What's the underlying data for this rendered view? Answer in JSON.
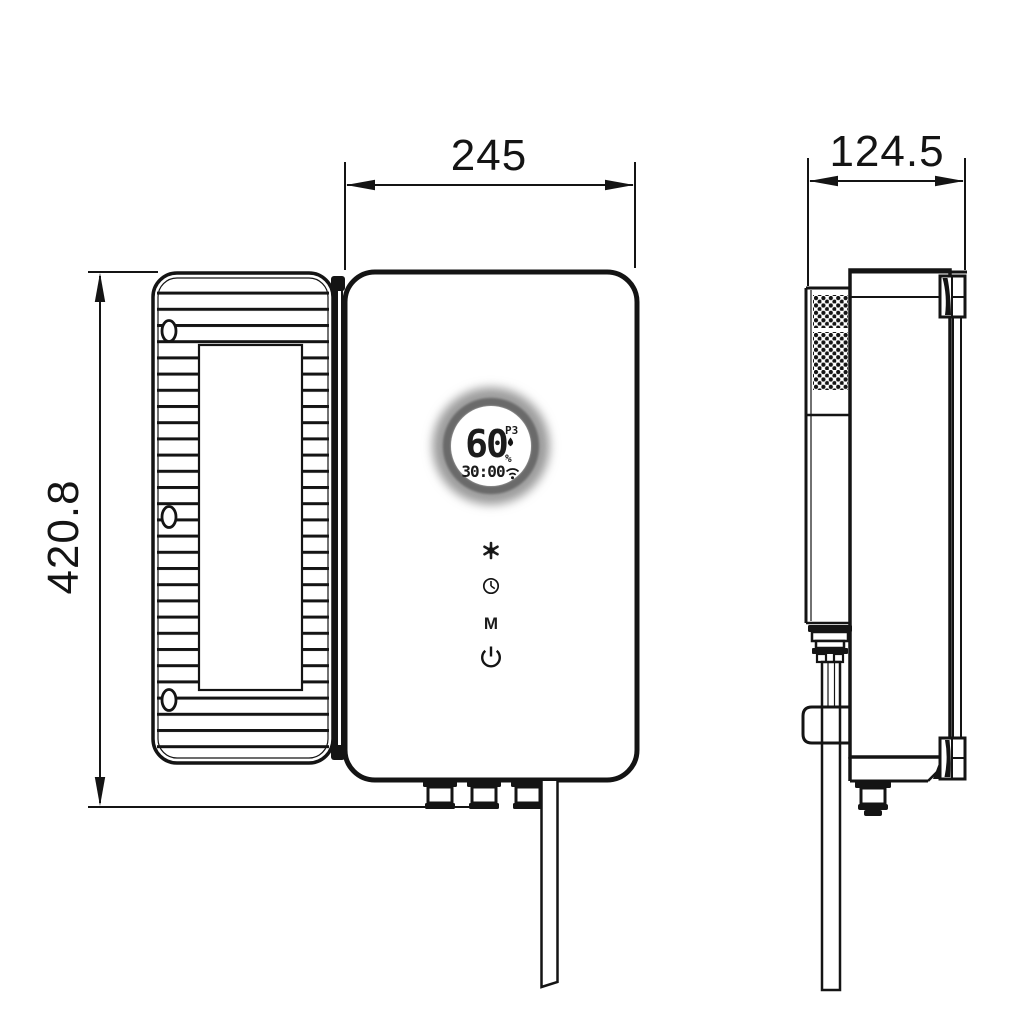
{
  "drawing": {
    "type": "technical-dimension-drawing",
    "subject": "wall-mounted-water-heater",
    "background": "#ffffff",
    "line_color": "#141414"
  },
  "dimensions": {
    "front_width": "245",
    "front_height": "420.8",
    "side_depth": "124.5"
  },
  "display": {
    "temperature": "60",
    "program": "P3",
    "percent": "%",
    "timer": "30:00",
    "ring_color": "#6a6a6a",
    "icons": [
      "droplet-icon",
      "wifi-icon"
    ]
  },
  "controls": {
    "mode_label": "M",
    "buttons": [
      "snowflake-icon",
      "clock-icon",
      "mode-button",
      "power-icon"
    ]
  },
  "views": [
    "front-view",
    "side-view"
  ]
}
